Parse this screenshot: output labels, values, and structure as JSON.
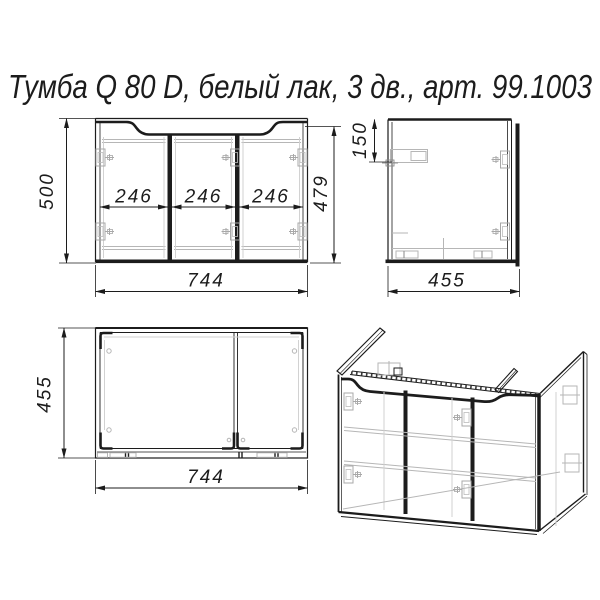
{
  "title": "Тумба Q 80 D, белый лак, 3 дв., арт. 99.1003",
  "colors": {
    "line": "#1c1c1c",
    "light_line": "#b6b6b6",
    "background": "#ffffff"
  },
  "front_view": {
    "overall_height_mm": "500",
    "door_height_mm": "479",
    "overall_width_mm": "744",
    "door_widths_mm": [
      "246",
      "246",
      "246"
    ]
  },
  "side_view": {
    "top_inset_mm": "150",
    "depth_mm": "455"
  },
  "top_view": {
    "depth_mm": "455",
    "width_mm": "744"
  }
}
